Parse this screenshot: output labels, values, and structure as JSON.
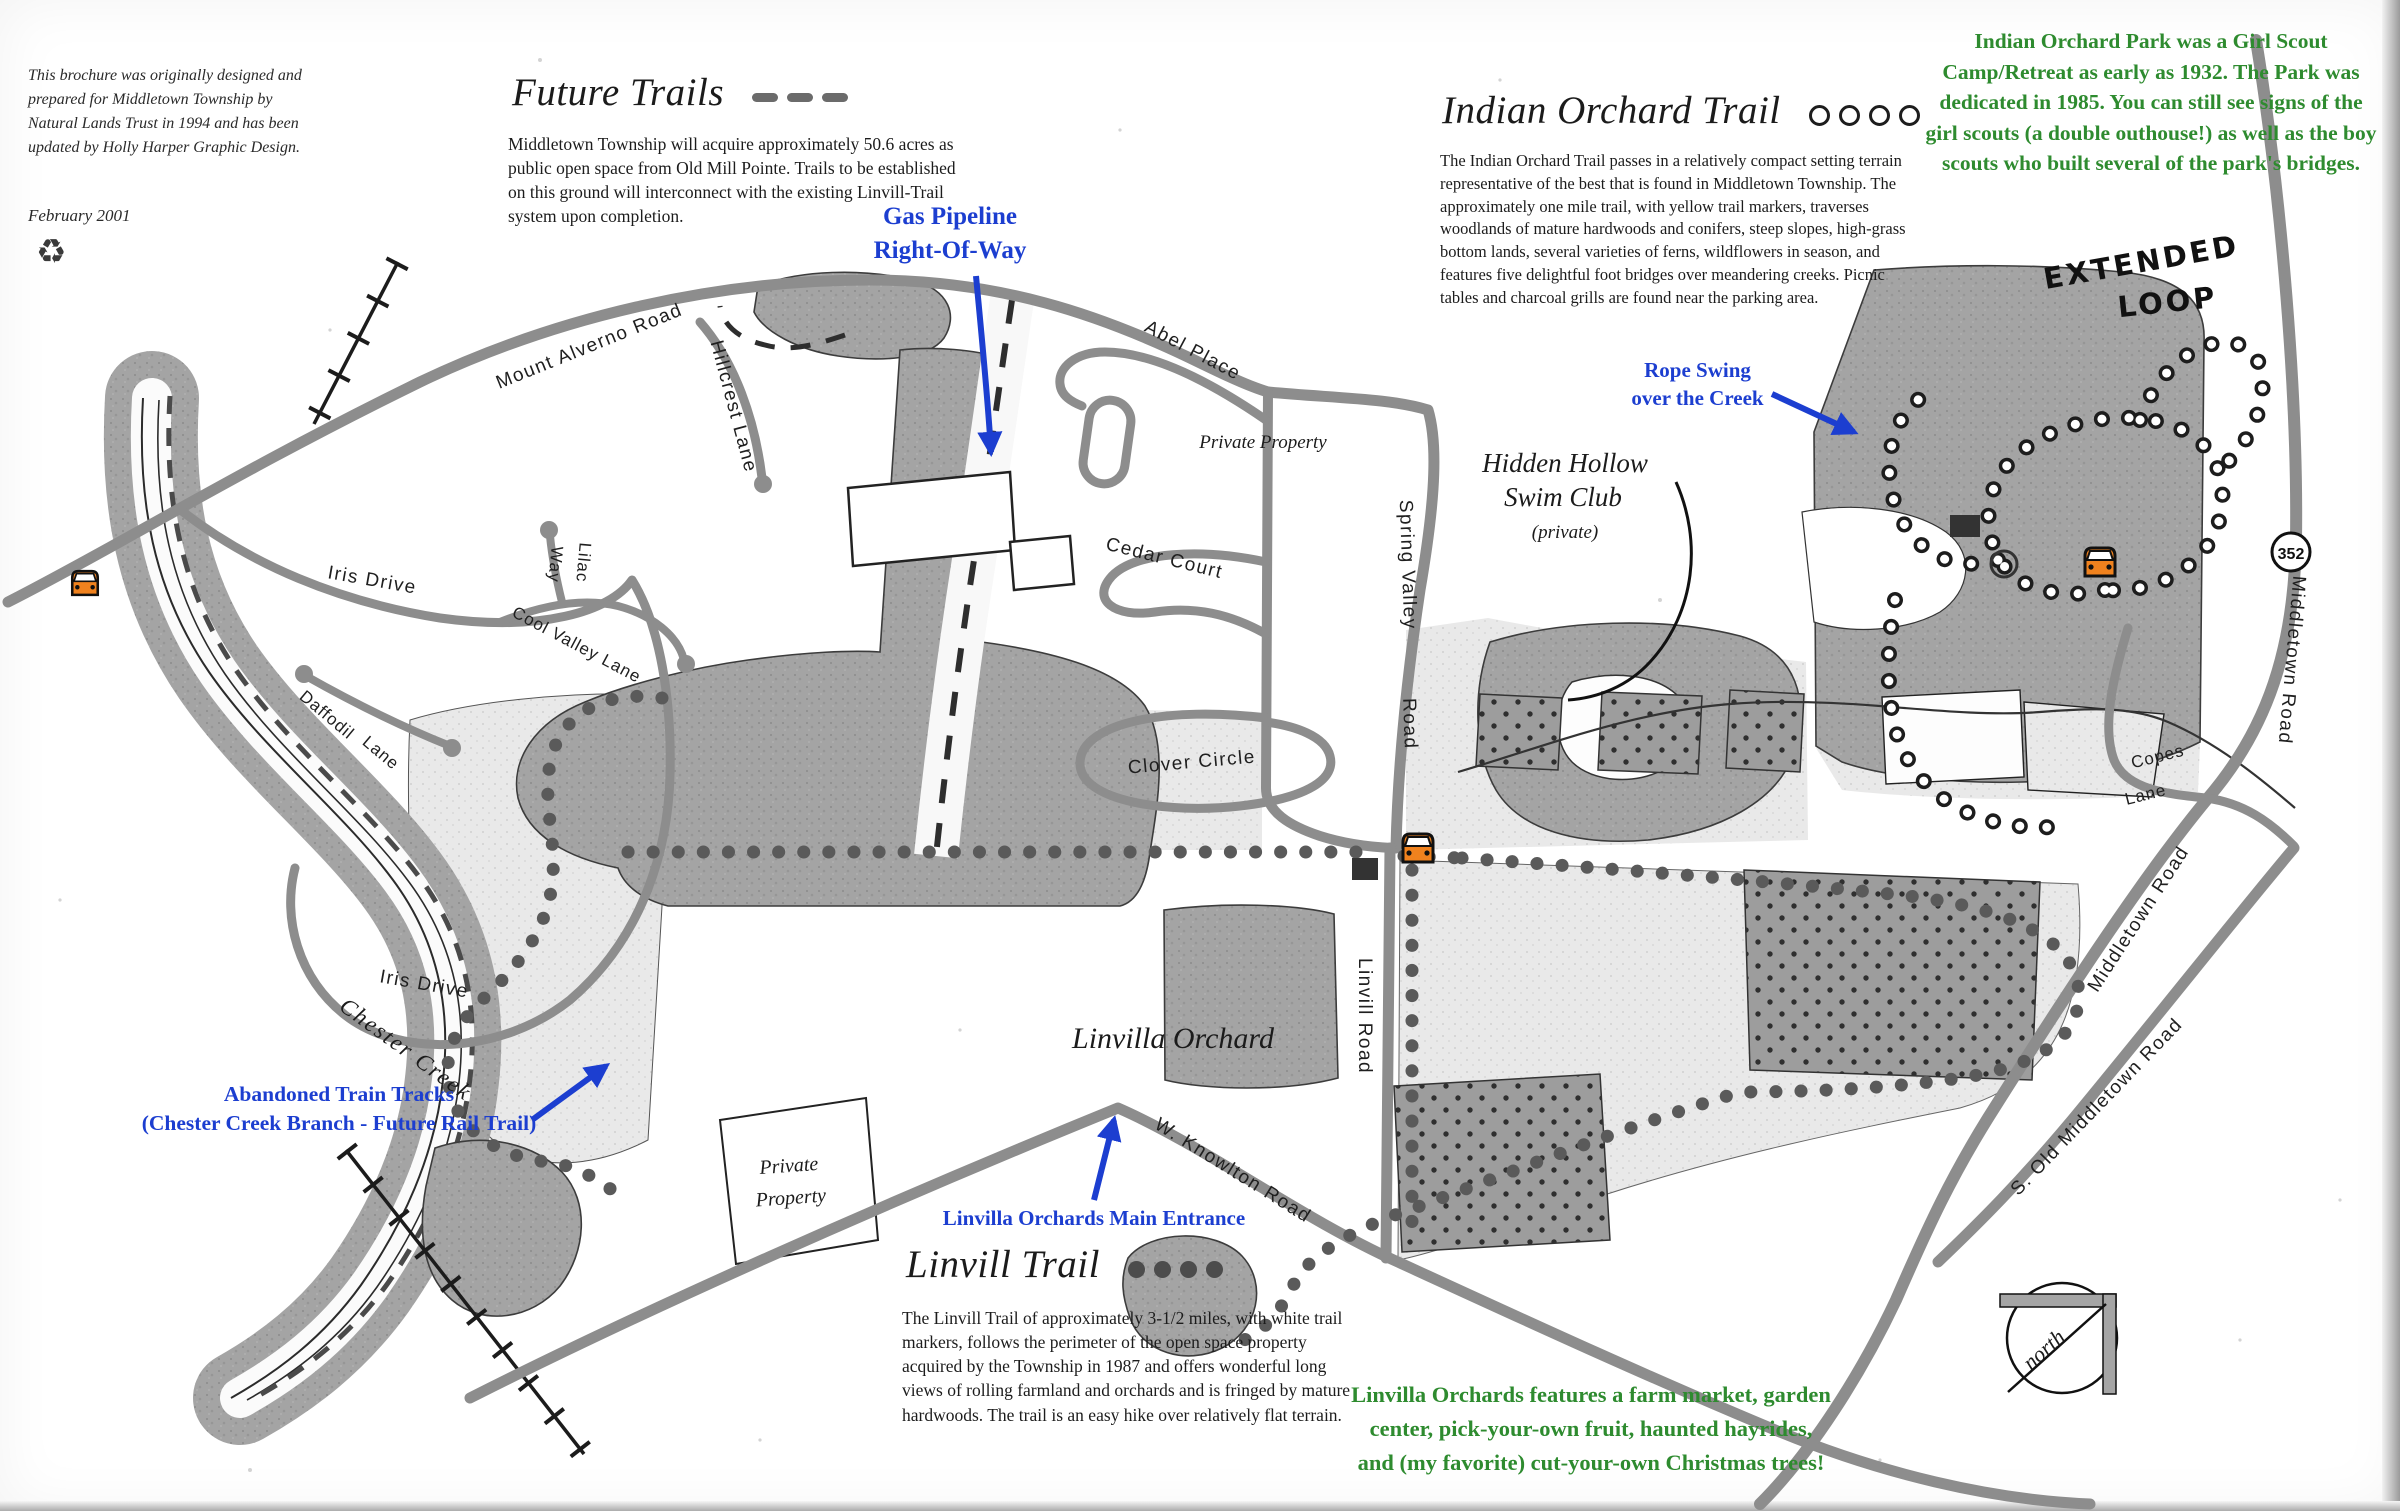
{
  "colors": {
    "annotation_blue": "#1c3ed0",
    "annotation_green": "#2e8b2f",
    "car_orange": "#f0821e",
    "road_gray": "#8d8d8d",
    "woods_gray": "#a4a4a4",
    "meadow_gray": "#e9e9e9",
    "ink": "#1b1b1b"
  },
  "credit": {
    "text": "This brochure was originally designed and\nprepared for Middletown Township by\nNatural Lands Trust in 1994 and has been\nupdated by Holly Harper Graphic Design.",
    "date": "February 2001",
    "recycle_icon": "♻"
  },
  "sections": {
    "future_trails": {
      "title": "Future Trails",
      "body": "Middletown Township will acquire approximately 50.6 acres as public open space from Old Mill Pointe.  Trails to be established on this ground will interconnect with the existing Linvill-Trail system upon completion."
    },
    "indian_orchard_trail": {
      "title": "Indian Orchard Trail",
      "body": "The Indian Orchard Trail passes in a relatively compact setting terrain representative of the best that is found in Middletown Township.  The approximately one mile trail, with yellow trail markers, traverses woodlands of mature hardwoods and conifers, steep slopes, high-grass bottom lands, several varieties of ferns, wildflowers in season, and features five delightful foot bridges over meandering creeks.  Picnic tables and charcoal grills are found near the parking area."
    },
    "linvill_trail": {
      "title": "Linvill Trail",
      "body": "The Linvill Trail of approximately 3-1/2 miles, with white trail markers, follows the perimeter of the open space property acquired by the Township in 1987 and offers wonderful long views of rolling farmland and orchards and is fringed by mature hardwoods.  The trail is an easy hike over relatively flat terrain."
    }
  },
  "annotations": {
    "girl_scout_note": "Indian Orchard Park was a Girl Scout\nCamp/Retreat as early as 1932.  The Park was\ndedicated in 1985.  You can still see signs of the\ngirl scouts (a double outhouse!) as well as the boy\nscouts who built several of the park's bridges.",
    "linvilla_note": "Linvilla Orchards features a farm market, garden\ncenter, pick-your-own fruit, haunted hayrides,\nand (my favorite) cut-your-own Christmas trees!",
    "gas_pipeline": "Gas Pipeline\nRight-Of-Way",
    "rope_swing": "Rope Swing\nover the Creek",
    "abandoned_tracks": "Abandoned Train Tracks\n(Chester Creek Branch - Future Rail Trail)",
    "main_entrance": "Linvilla Orchards Main Entrance",
    "extended_loop_line1": "EXTENDED",
    "extended_loop_line2": "LOOP"
  },
  "map_labels": {
    "mount_alverno": "Mount Alverno Road",
    "hillcrest": "Hillcrest Lane",
    "abel": "Abel Place",
    "cedar": "Cedar Court",
    "clover": "Clover Circle",
    "spring_valley": "Spring Valley",
    "spring_valley_road": "Road",
    "iris_upper": "Iris Drive",
    "iris_lower": "Iris Drive",
    "lilac_line1": "Lilac",
    "lilac_line2": "Way",
    "cool_valley": "Cool Valley Lane",
    "daffodil_line1": "Daffodil",
    "daffodil_line2": "Lane",
    "chester_creek": "Chester Creek",
    "linvill_road": "Linvill Road",
    "w_knowlton": "W. Knowlton Road",
    "middletown_upper": "Middletown Road",
    "middletown_lower": "Middletown Road",
    "s_old_middletown": "S. Old Middletown Road",
    "copes_line1": "Copes",
    "copes_line2": "Lane",
    "route_352": "352",
    "north": "north",
    "linvilla_orchard": "Linvilla Orchard",
    "hidden_hollow_line1": "Hidden Hollow",
    "hidden_hollow_line2": "Swim Club",
    "hidden_hollow_line3": "(private)",
    "private_property_right": "Private Property",
    "private_left_line1": "Private",
    "private_left_line2": "Property"
  }
}
